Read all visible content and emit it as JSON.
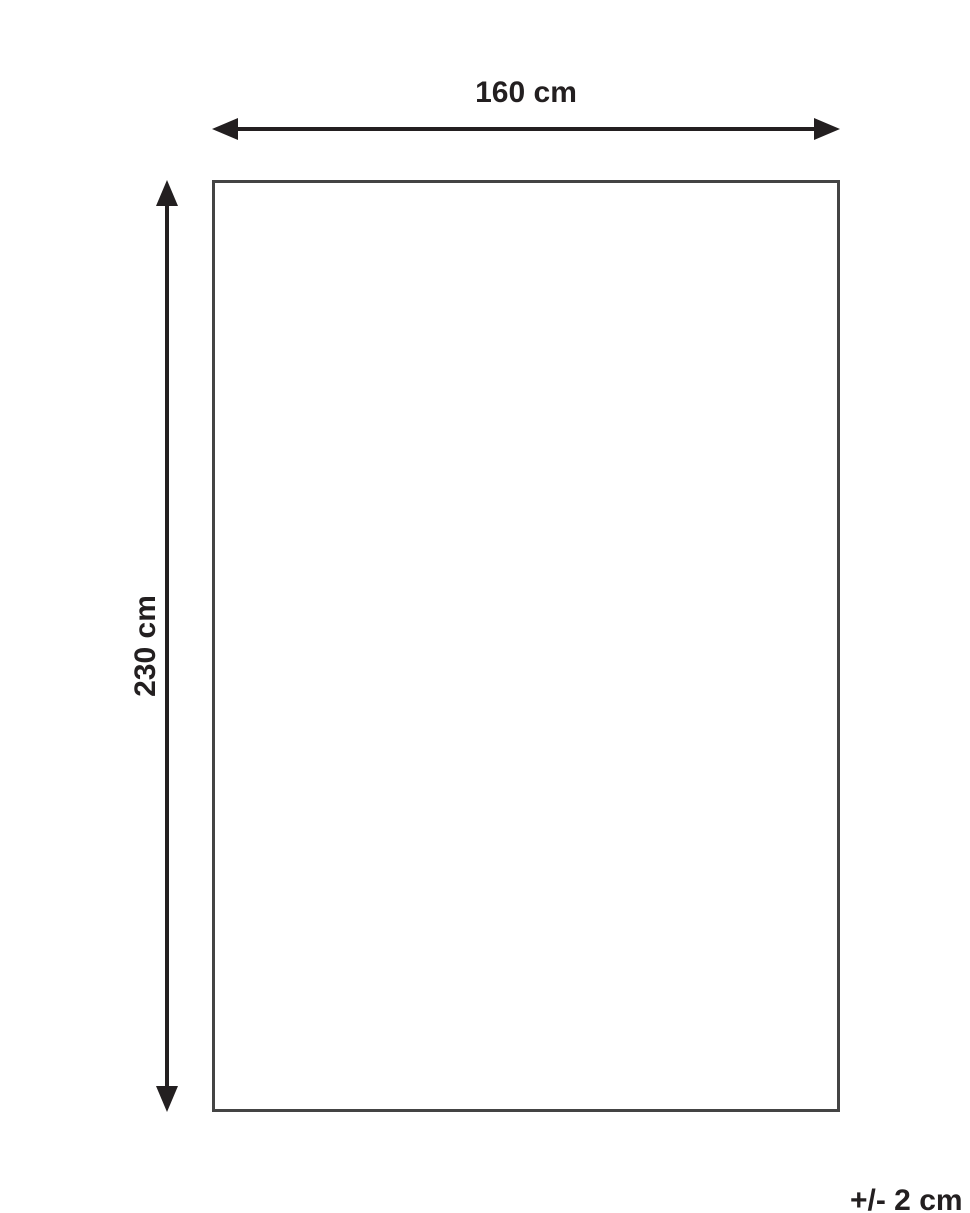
{
  "diagram": {
    "width_label": "160 cm",
    "height_label": "230 cm",
    "tolerance_label": "+/- 2 cm"
  },
  "colors": {
    "ink": "#231f20",
    "outline": "#444444",
    "background": "#ffffff"
  }
}
